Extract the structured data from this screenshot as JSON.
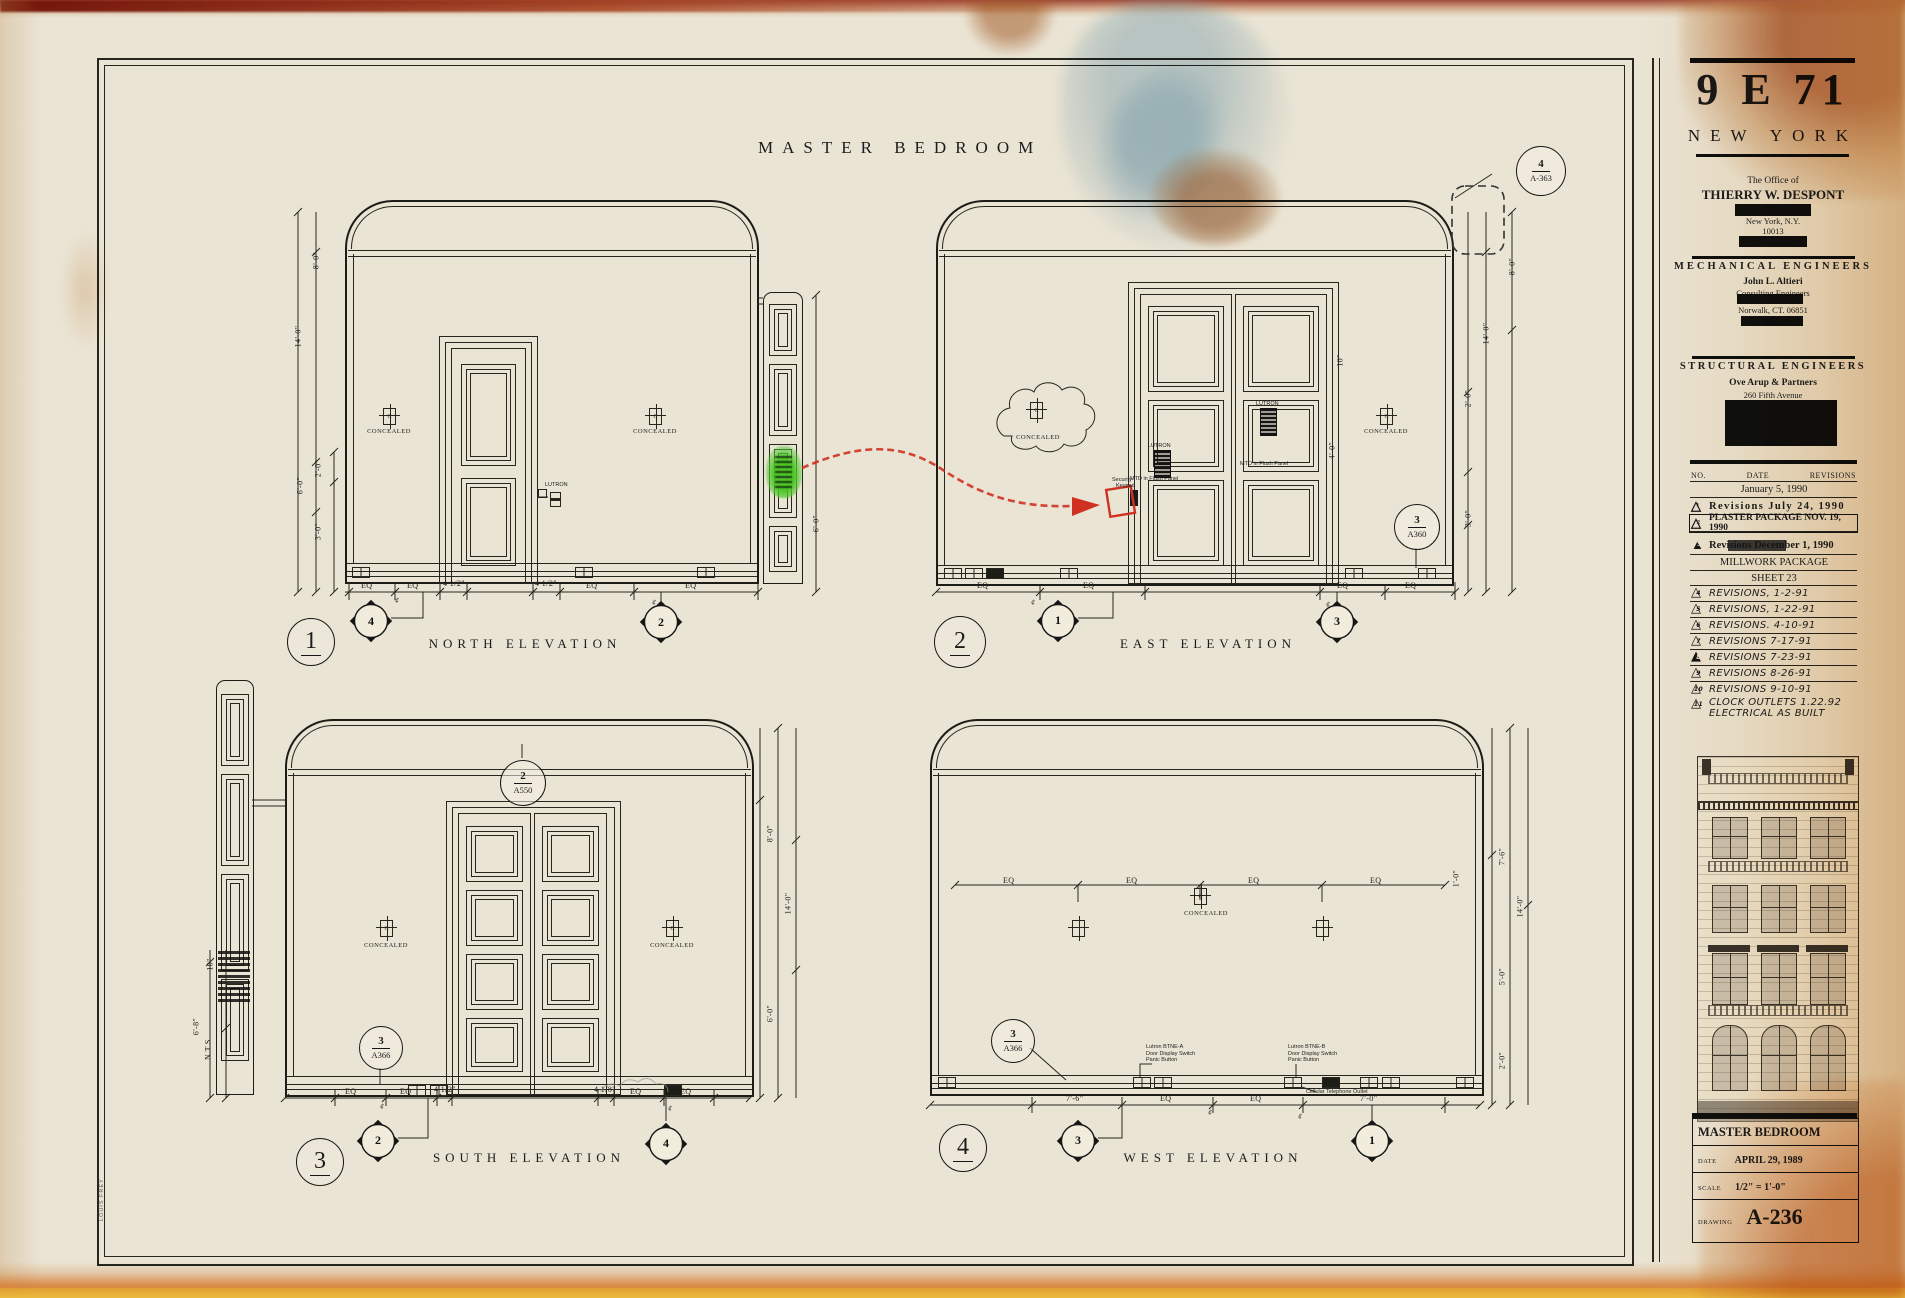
{
  "sheet_title": "MASTER BEDROOM",
  "symbols": {
    "concealed_c": "C",
    "centerline": "¢"
  },
  "titleblock": {
    "project": "9 E 71",
    "city": "NEW YORK",
    "office_of": "The Office of",
    "architect": "THIERRY W. DESPONT",
    "architect_city": "New York, N.Y.",
    "architect_zip": "10013",
    "mech_header": "MECHANICAL ENGINEERS",
    "mech_name": "John L. Altieri",
    "mech_sub": "Consulting Engineers",
    "mech_city": "Norwalk, CT. 06851",
    "struct_header": "STRUCTURAL ENGINEERS",
    "struct_name": "Ove Arup & Partners",
    "struct_addr": "260 Fifth Avenue",
    "room": "MASTER BEDROOM",
    "date_label": "DATE",
    "date_value": "APRIL 29, 1989",
    "scale_label": "SCALE",
    "scale_value": "1/2\" = 1'-0\"",
    "drawing_label": "DRAWING",
    "drawing_no": "A-236",
    "printer_stamp": "LOUIS FREY"
  },
  "revisions": {
    "col_no": "NO.",
    "col_date": "DATE",
    "col_rev": "REVISIONS",
    "rows": [
      {
        "tri": "",
        "text": "January 5, 1990"
      },
      {
        "tri": "1",
        "text": "Revisions  July 24, 1990"
      },
      {
        "tri": "2",
        "text": "PLASTER PACKAGE NOV. 19, 1990"
      },
      {
        "tri": "3",
        "text": "Revisions December 1, 1990"
      },
      {
        "tri": "",
        "text": "MILLWORK PACKAGE"
      },
      {
        "tri": "",
        "text": "SHEET 23"
      },
      {
        "tri": "4",
        "text": "REVISIONS, 1-2-91"
      },
      {
        "tri": "5",
        "text": "REVISIONS, 1-22-91"
      },
      {
        "tri": "6",
        "text": "REVISIONS. 4-10-91"
      },
      {
        "tri": "7",
        "text": "REVISIONS 7-17-91"
      },
      {
        "tri": "8",
        "text": "REVISIONS 7-23-91"
      },
      {
        "tri": "9",
        "text": "REVISIONS 8-26-91"
      },
      {
        "tri": "10",
        "text": "REVISIONS 9-10-91"
      },
      {
        "tri": "11",
        "text": "CLOCK OUTLETS 1.22.92",
        "text2": "ELECTRICAL AS BUILT"
      }
    ]
  },
  "elevations": {
    "north": {
      "number": "1",
      "name": "NORTH ELEVATION",
      "concealed": "CONCEALED",
      "lutron": "LUTRON",
      "dims_left": [
        "8'-0\"",
        "14'-0\"",
        "2'-0\"",
        "6'-0\"",
        "3'-0\""
      ],
      "dim_right": "6'-0\"",
      "dims_bottom": [
        "EQ",
        "EQ",
        "4 1/2\"",
        "4 1/2\"",
        "EQ",
        "EQ"
      ],
      "diamonds": [
        "4",
        "2"
      ]
    },
    "east": {
      "number": "2",
      "name": "EAST ELEVATION",
      "concealed": "CONCEALED",
      "lutron": "LUTRON",
      "mtd": "MTD in Flush Panel",
      "security_1": "Security",
      "security_2": "Keypad",
      "callout_top": {
        "num": "4",
        "sheet": "A-363"
      },
      "callout_right": {
        "num": "3",
        "sheet": "A360"
      },
      "dims_right": [
        "8'-0\"",
        "14'-0\"",
        "2'-0\"",
        "3'-0\""
      ],
      "dims_inner": [
        "10\"",
        "4'-0\""
      ],
      "dims_bottom": [
        "EQ",
        "EQ",
        "EQ",
        "EQ"
      ],
      "diamonds": [
        "1",
        "3"
      ]
    },
    "south": {
      "number": "3",
      "name": "SOUTH ELEVATION",
      "concealed": "CONCEALED",
      "callout_top": {
        "num": "2",
        "sheet": "A550"
      },
      "callout_left": {
        "num": "3",
        "sheet": "A366"
      },
      "dims_left": [
        "10\"",
        "6'-8\"",
        "N.T.S."
      ],
      "dims_right": [
        "8'-0\"",
        "14'-0\"",
        "6'-0\""
      ],
      "dims_bottom": [
        "EQ",
        "EQ",
        "4 1/2\"",
        "4 1/8\"",
        "EQ",
        "EQ"
      ],
      "diamonds": [
        "2",
        "4"
      ]
    },
    "west": {
      "number": "4",
      "name": "WEST ELEVATION",
      "concealed": "CONCEALED",
      "callout": {
        "num": "3",
        "sheet": "A366"
      },
      "dims_mid": [
        "EQ",
        "EQ",
        "EQ",
        "EQ"
      ],
      "dim_small": "1'-0\"",
      "dims_right": [
        "7'-6\"",
        "14'-0\"",
        "5'-0\"",
        "2'-0\""
      ],
      "dims_bottom": [
        "7'-6\"",
        "EQ",
        "EQ",
        "7'-0\""
      ],
      "lutron_a": [
        "Lutron BTNE-A",
        "Door Display Switch",
        "Panic Button"
      ],
      "lutron_b": [
        "Lutron BTNE-B",
        "Door Display Switch",
        "Panic Button"
      ],
      "cellular": "Cellular Telephone Outlet",
      "diamonds": [
        "3",
        "1"
      ]
    }
  }
}
